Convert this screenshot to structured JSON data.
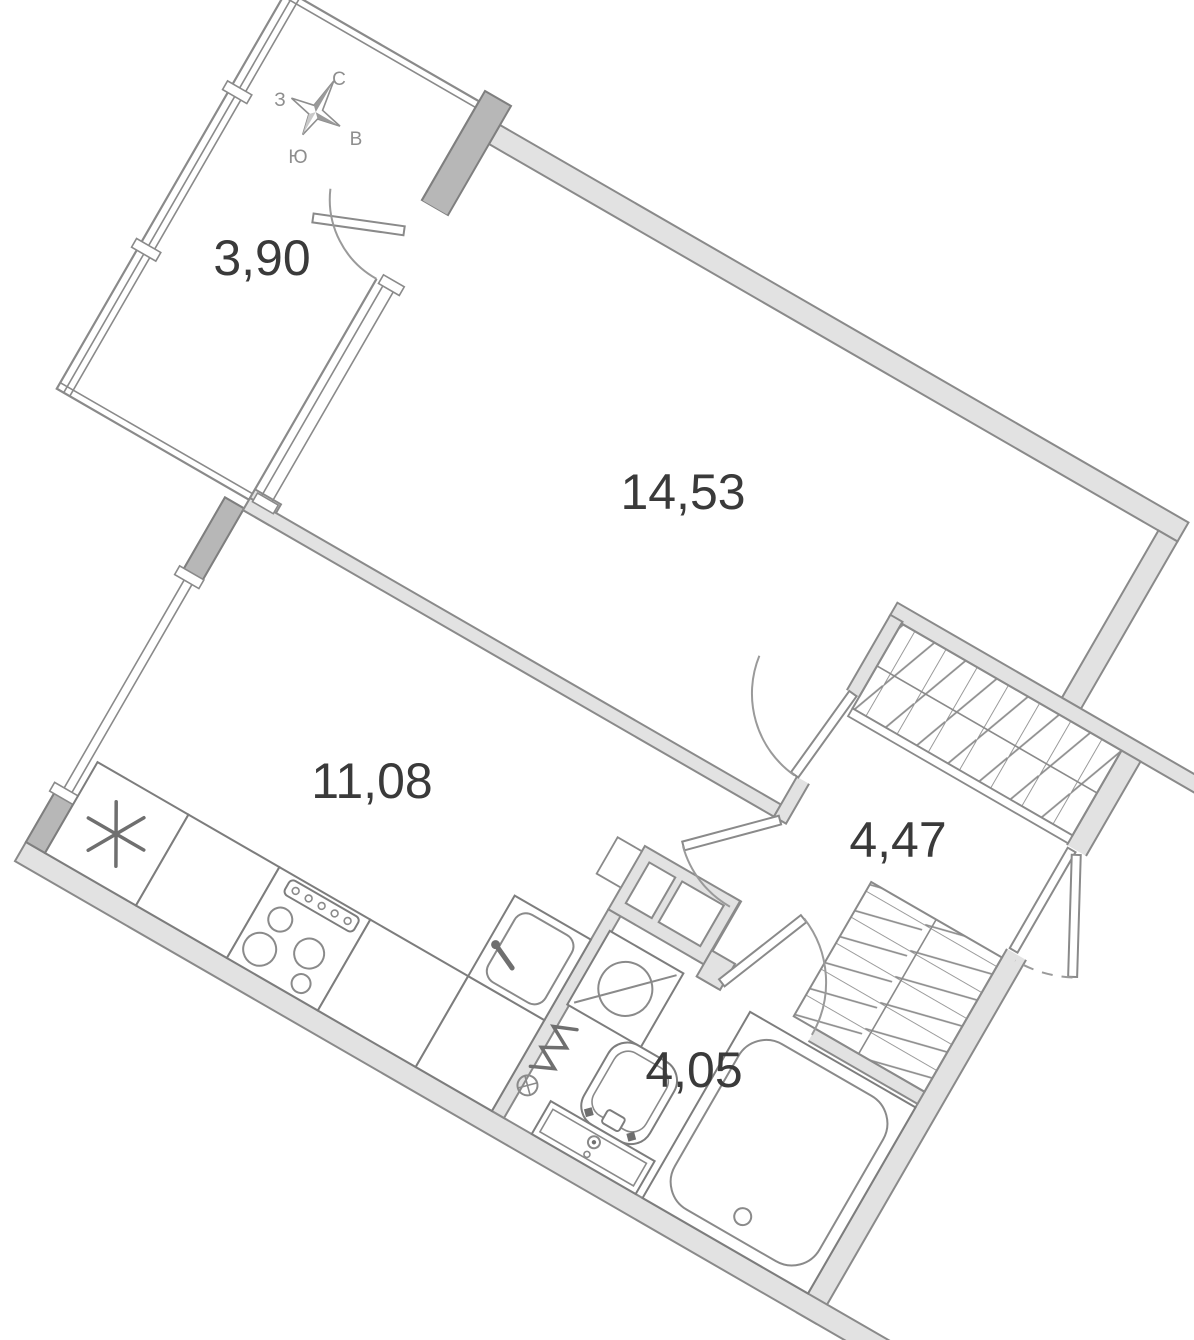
{
  "plan": {
    "type": "apartment-floor-plan",
    "rotation_deg": 30,
    "compass": {
      "north": "С",
      "east": "В",
      "south": "Ю",
      "west": "З"
    },
    "rooms": [
      {
        "name": "balcony",
        "area": "3,90"
      },
      {
        "name": "living-room",
        "area": "14,53"
      },
      {
        "name": "kitchen",
        "area": "11,08"
      },
      {
        "name": "hallway",
        "area": "4,47"
      },
      {
        "name": "bathroom",
        "area": "4,05"
      }
    ],
    "colors": {
      "wall_fill": "#e2e2e2",
      "wall_dark": "#b7b7b7",
      "outline": "#8a8a8a",
      "fixture_line": "#7d7d7d",
      "label_text": "#3a3a3a",
      "compass_text": "#8e8e8e",
      "background": "#ffffff"
    }
  }
}
